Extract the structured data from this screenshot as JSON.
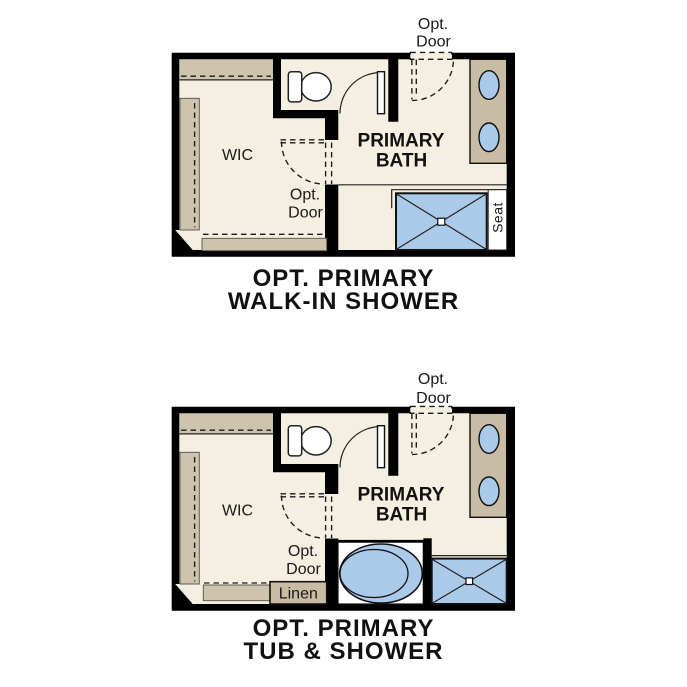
{
  "colors": {
    "floor": "#F5EFE1",
    "shelf_tan": "#CEC3AC",
    "counter_tan": "#C8BCA4",
    "fixture_blue": "#ABC9E8",
    "wall": "#000000"
  },
  "plans": {
    "walk_in_shower": {
      "caption": {
        "line1": "OPT. PRIMARY",
        "line2": "WALK-IN SHOWER"
      },
      "labels": {
        "opt_door_top_1": "Opt.",
        "opt_door_top_2": "Door",
        "wic": "WIC",
        "bath_1": "PRIMARY",
        "bath_2": "BATH",
        "opt_door_mid_1": "Opt.",
        "opt_door_mid_2": "Door",
        "seat": "Seat"
      }
    },
    "tub_shower": {
      "caption": {
        "line1": "OPT. PRIMARY",
        "line2": "TUB & SHOWER"
      },
      "labels": {
        "opt_door_top_1": "Opt.",
        "opt_door_top_2": "Door",
        "wic": "WIC",
        "bath_1": "PRIMARY",
        "bath_2": "BATH",
        "opt_door_mid_1": "Opt.",
        "opt_door_mid_2": "Door",
        "linen": "Linen"
      }
    }
  }
}
